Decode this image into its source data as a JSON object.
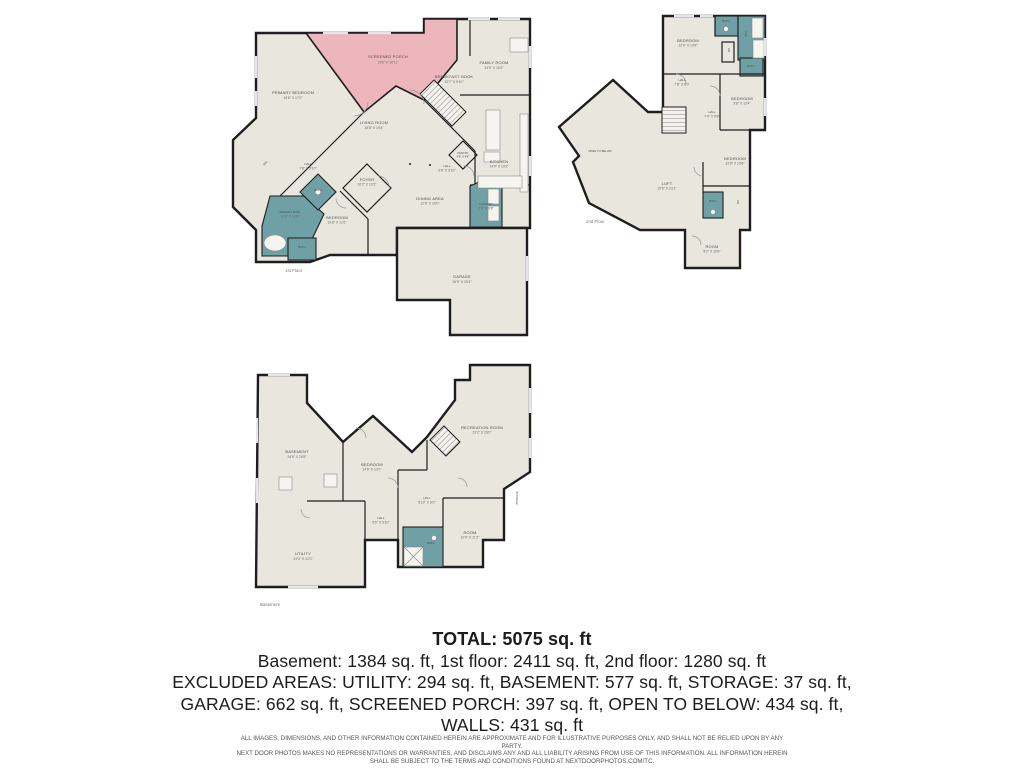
{
  "colors": {
    "floor": "#e9e6de",
    "wall": "#1e1e1e",
    "porch_pink": "#edb6bd",
    "bath_teal": "#6fa0a6",
    "label_gray": "#4f4f4f"
  },
  "floors": {
    "first": {
      "caption": "1st Floor",
      "rooms": {
        "screened_porch": {
          "label": "SCREENED PORCH",
          "dims": "23'6\" X 16'11\""
        },
        "primary_bedroom": {
          "label": "PRIMARY BEDROOM",
          "dims": "15'8\" X 17'0\""
        },
        "family_room": {
          "label": "FAMILY ROOM",
          "dims": "14'0\" X 15'2\""
        },
        "breakfast_nook": {
          "label": "BREAKFAST NOOK",
          "dims": "10'7\" X 9'10\""
        },
        "living_room": {
          "label": "LIVING ROOM",
          "dims": "16'8\" X 19'4\""
        },
        "kitchen": {
          "label": "KITCHEN",
          "dims": "14'0\" X 19'2\""
        },
        "dining_area": {
          "label": "DINING AREA",
          "dims": "12'6\" X 16'0\""
        },
        "hall1": {
          "label": "HALL",
          "dims": "7'8\" X 5'10\""
        },
        "hall2": {
          "label": "HALL",
          "dims": "6'6\" X 5'10\""
        },
        "foyer": {
          "label": "FOYER",
          "dims": "10'2\" X 10'2\""
        },
        "pantry": {
          "label": "PANTRY",
          "dims": "4'8\" X 4'8\""
        },
        "laundry": {
          "label": "LAUNDRY",
          "dims": "7'6\" X 9'8\""
        },
        "primary_bath": {
          "label": "PRIMARY BATH",
          "dims": "13'6\" X 12'8\""
        },
        "bath_small": {
          "label": "BATH",
          "dims": "6'4\" X 6'4\""
        },
        "bath2": {
          "label": "BATH",
          "dims": "8'2\" X 5'0\""
        },
        "bedroom": {
          "label": "BEDROOM",
          "dims": "10'8\" X 12'6\""
        },
        "wic": {
          "label": "WIC",
          "dims": "7'8\" X 5'4\""
        },
        "garage": {
          "label": "GARAGE",
          "dims": "26'5\" X 25'1\""
        }
      }
    },
    "second": {
      "caption": "2nd Floor",
      "rooms": {
        "bedroom1": {
          "label": "BEDROOM",
          "dims": "12'6\" X 13'8\""
        },
        "bath1": {
          "label": "BATH",
          "dims": "6'0\" X 6'5\""
        },
        "wic": {
          "label": "WIC"
        },
        "lin": {
          "label": "LIN"
        },
        "bath2": {
          "label": "BATH",
          "dims": "7'8\" X 6'0\""
        },
        "hall1": {
          "label": "HALL",
          "dims": "7'8\" X 8'0\""
        },
        "hall2": {
          "label": "HALL",
          "dims": "7'4\" X 8'8\""
        },
        "bedroom2": {
          "label": "BEDROOM",
          "dims": "9'8\" X 13'4\""
        },
        "bedroom3": {
          "label": "BEDROOM",
          "dims": "12'8\" X 13'6\""
        },
        "bath3": {
          "label": "BATH",
          "dims": "7'8\" X 5'4\""
        },
        "lin2": {
          "label": "LIN"
        },
        "open_below": {
          "label": "OPEN TO BELOW"
        },
        "loft": {
          "label": "LOFT",
          "dims": "19'6\" X 23'1\""
        },
        "room": {
          "label": "ROOM",
          "dims": "8'2\" X 10'6\""
        }
      }
    },
    "basement": {
      "caption": "Basement",
      "rooms": {
        "basement_room": {
          "label": "BASEMENT",
          "dims": "24'6\" X 26'8\""
        },
        "bedroom": {
          "label": "BEDROOM",
          "dims": "14'6\" X 13'2\""
        },
        "rec_room": {
          "label": "RECREATION ROOM",
          "dims": "23'2\" X 26'0\""
        },
        "hall1": {
          "label": "HALL",
          "dims": "5'10\" X 8'0\""
        },
        "hall2": {
          "label": "HALL",
          "dims": "6'6\" X 5'10\""
        },
        "bath": {
          "label": "BATH",
          "dims": "9'10\" X 5'0\""
        },
        "room": {
          "label": "ROOM",
          "dims": "10'6\" X 11'2\""
        },
        "storage": {
          "label": "STORAGE"
        },
        "utility": {
          "label": "UTILITY",
          "dims": "24'0\" X 12'3\""
        }
      }
    }
  },
  "summary": {
    "total": "TOTAL: 5075 sq. ft",
    "line1": "Basement: 1384 sq. ft, 1st floor: 2411 sq. ft, 2nd floor: 1280 sq. ft",
    "line2": "EXCLUDED AREAS: UTILITY: 294 sq. ft, BASEMENT: 577 sq. ft, STORAGE: 37 sq. ft,",
    "line3": "GARAGE: 662 sq. ft, SCREENED PORCH: 397 sq. ft, OPEN TO BELOW: 434 sq. ft,",
    "line4": "WALLS: 431 sq. ft"
  },
  "disclaimer": {
    "line1": "ALL IMAGES, DIMENSIONS, AND OTHER INFORMATION CONTAINED HEREIN ARE APPROXIMATE AND FOR ILLUSTRATIVE PURPOSES ONLY, AND SHALL NOT BE RELIED UPON BY ANY PARTY.",
    "line2": "NEXT DOOR PHOTOS MAKES NO REPRESENTATIONS OR WARRANTIES, AND DISCLAIMS ANY AND ALL LIABILITY ARISING FROM USE OF THIS INFORMATION. ALL INFORMATION HEREIN",
    "line3": "SHALL BE SUBJECT TO THE TERMS AND CONDITIONS FOUND AT NEXTDOORPHOTOS.COM/TC."
  }
}
